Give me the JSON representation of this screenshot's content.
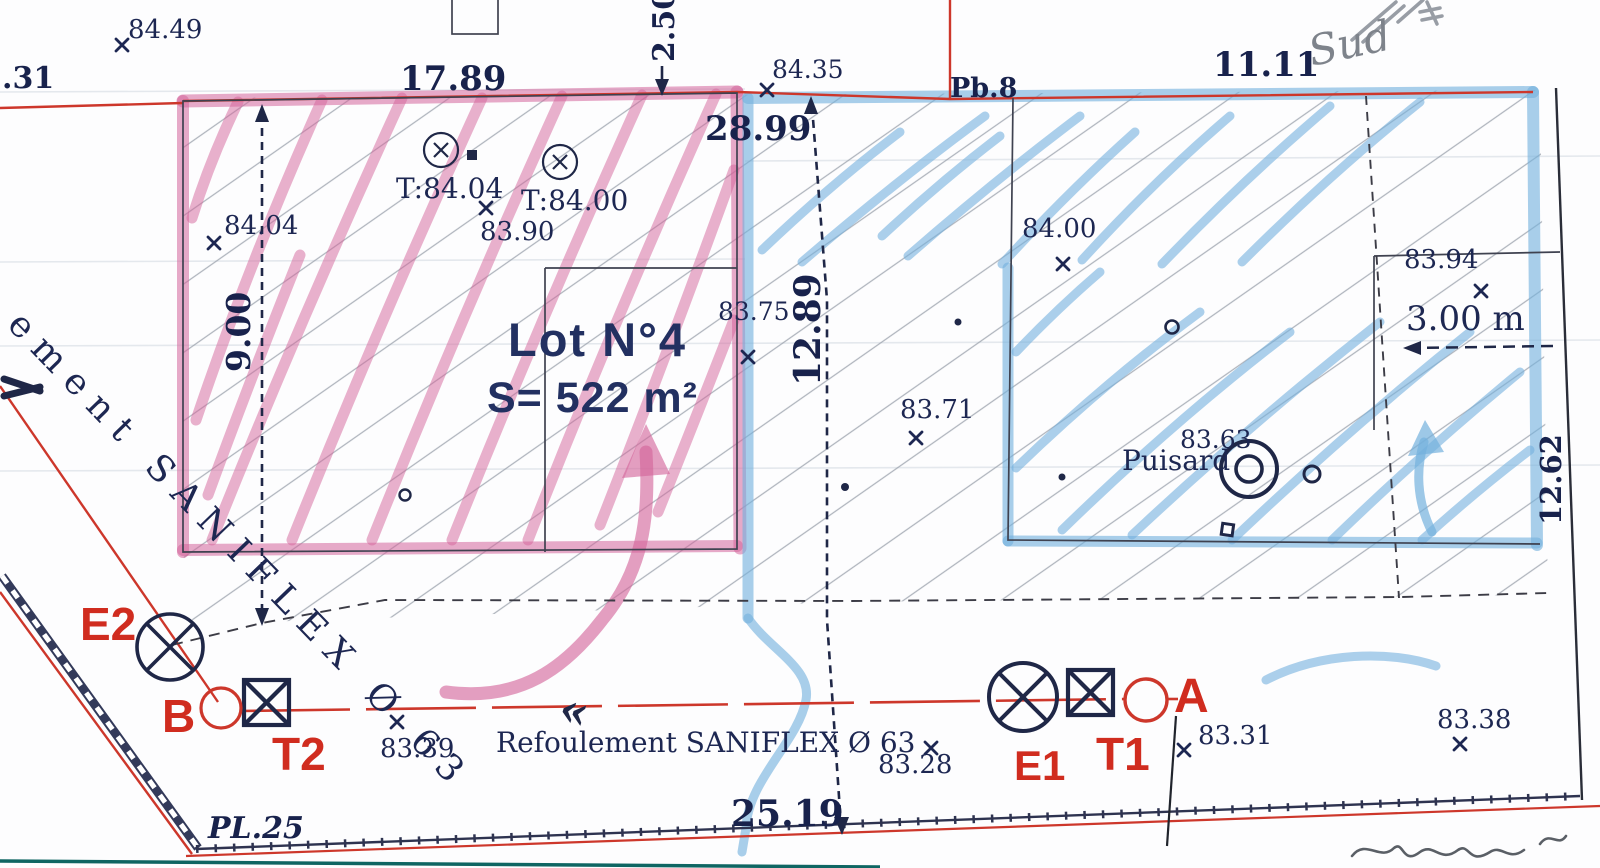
{
  "colors": {
    "navy_text": "#1d2752",
    "red_line": "#cd372b",
    "red_letters": "#d02c1f",
    "pink_highlighter": "#d4649a",
    "blue_highlighter": "#74b1dd",
    "teal_line": "#0f6663",
    "pencil_gray": "#8b9097"
  },
  "plan": {
    "lot": {
      "name": "Lot N°4",
      "area": "S= 522 m²"
    },
    "dims": {
      "left_partial": ".31",
      "top_left": "17.89",
      "top_offset": "2.50",
      "mid": "28.99",
      "top_right": "11.11",
      "height_left": "9.00",
      "height_mid": "12.89",
      "bottom": "25.19",
      "strip_width": "3.00 m",
      "height_right": "12.62"
    },
    "elev": {
      "p8449": "84.49",
      "p8435": "84.35",
      "p8404": "84.04",
      "t8404": "T:84.04",
      "t8400": "T:84.00",
      "p8390": "83.90",
      "p8400": "84.00",
      "p8394": "83.94",
      "p8375": "83.75",
      "p8371": "83.71",
      "p8363": "83.63",
      "p8339": "83.39",
      "p8328": "83.28",
      "p8331": "83.31",
      "p8338": "83.38"
    },
    "labels": {
      "pb8": "Pb.8",
      "pl25": "PL.25",
      "sud": "Sud",
      "puisard": "Puisard",
      "pipe_main": "Refoulement SANIFLEX Ø 63",
      "pipe_left_fragment": "ement SANIFLEX Ø 63",
      "chevrons": "«"
    },
    "points": {
      "e2": "E2",
      "b": "B",
      "t2": "T2",
      "e1": "E1",
      "t1": "T1",
      "a": "A"
    }
  }
}
